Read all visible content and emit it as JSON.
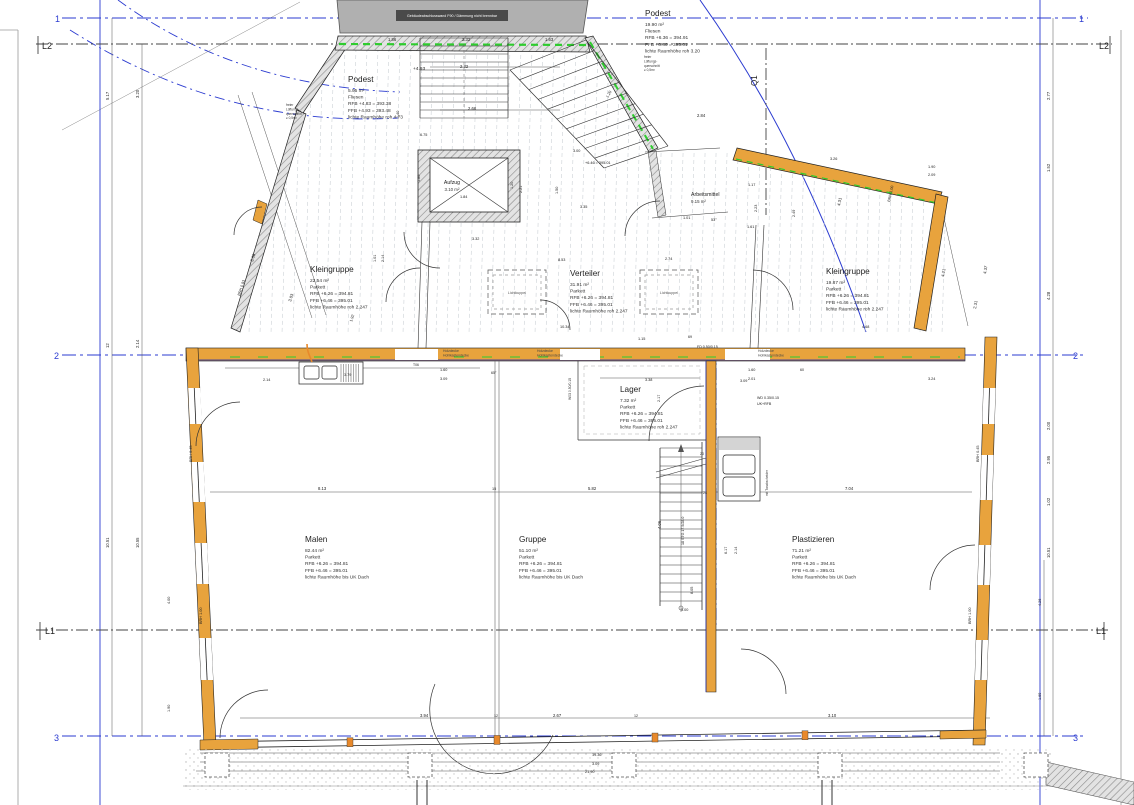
{
  "colors": {
    "axis_blue": "#2b3bd0",
    "wall_orange": "#e8a33d",
    "insulation_green": "#2ecc2e",
    "existing_gray": "#b0b0b0",
    "label_bar_gray": "#4a4a4a",
    "line_black": "#222222"
  },
  "axis_labels": [
    {
      "t": "1",
      "x": 55,
      "y": 22,
      "c": "#2b3bd0",
      "s": 9
    },
    {
      "t": "1",
      "x": 1079,
      "y": 22,
      "c": "#2b3bd0",
      "s": 9
    },
    {
      "t": "L2",
      "x": 42,
      "y": 49,
      "c": "#222222",
      "s": 9
    },
    {
      "t": "L2",
      "x": 1099,
      "y": 49,
      "c": "#222222",
      "s": 9
    },
    {
      "t": "2",
      "x": 54,
      "y": 359,
      "c": "#2b3bd0",
      "s": 9
    },
    {
      "t": "2",
      "x": 1073,
      "y": 359,
      "c": "#2b3bd0",
      "s": 9
    },
    {
      "t": "L1",
      "x": 45,
      "y": 634,
      "c": "#222222",
      "s": 9
    },
    {
      "t": "L1",
      "x": 1096,
      "y": 634,
      "c": "#222222",
      "s": 9
    },
    {
      "t": "3",
      "x": 54,
      "y": 741,
      "c": "#2b3bd0",
      "s": 9
    },
    {
      "t": "3",
      "x": 1073,
      "y": 741,
      "c": "#2b3bd0",
      "s": 9
    },
    {
      "t": "Q1",
      "x": 757,
      "y": 86,
      "c": "#222222",
      "s": 8,
      "r": -90
    }
  ],
  "rooms": [
    {
      "name": "Podest",
      "sub": "+4.93",
      "subx": 413,
      "suby": 70,
      "x": 348,
      "y": 82,
      "area": "5.95 m²",
      "floor": "Fliesen",
      "rfb": "RFB +4.83 = 393.38",
      "ffb": "FFB +4.93 = 393.48",
      "height": "lichte Raumhöhe roh 4.73"
    },
    {
      "name": "Podest",
      "x": 645,
      "y": 16,
      "area": "19.90 m²",
      "floor": "Fliesen",
      "rfb": "RFB +6.36 = 394.91",
      "ffb": "FFB +6.46 = 395.01",
      "height": "lichte Raumhöhe roh 3.20"
    },
    {
      "name": "Kleingruppe",
      "x": 310,
      "y": 272,
      "area": "22.54 m²",
      "floor": "Parkett",
      "rfb": "RFB +6.26 = 394.81",
      "ffb": "FFB +6.46 = 395.01",
      "height": "lichte Raumhöhe roh 2.247"
    },
    {
      "name": "Verteiler",
      "x": 570,
      "y": 276,
      "area": "31.91 m²",
      "floor": "Parkett",
      "rfb": "RFB +6.26 = 394.81",
      "ffb": "FFB +6.46 = 395.01",
      "height": "lichte Raumhöhe roh 2.247"
    },
    {
      "name": "Arbeitsmittel",
      "x": 691,
      "y": 196,
      "area": "9.15 m²",
      "small": true
    },
    {
      "name": "Kleingruppe",
      "x": 826,
      "y": 274,
      "area": "19.87 m²",
      "floor": "Parkett",
      "rfb": "RFB +6.26 = 394.81",
      "ffb": "FFB +6.46 = 395.01",
      "height": "lichte Raumhöhe roh 2.247"
    },
    {
      "name": "Lager",
      "x": 620,
      "y": 392,
      "area": "7.32 m²",
      "floor": "Parkett",
      "rfb": "RFB +6.26 = 394.81",
      "ffb": "FFB +6.46 = 395.01",
      "height": "lichte Raumhöhe roh 2.247"
    },
    {
      "name": "Malen",
      "x": 305,
      "y": 542,
      "area": "82.44 m²",
      "floor": "Parkett",
      "rfb": "RFB +6.26 = 394.81",
      "ffb": "FFB +6.46 = 395.01",
      "height": "lichte Raumhöhe bis UK Dach"
    },
    {
      "name": "Gruppe",
      "x": 519,
      "y": 542,
      "area": "51.10 m²",
      "floor": "Parkett",
      "rfb": "RFB +6.26 = 394.81",
      "ffb": "FFB +6.46 = 395.01",
      "height": "lichte Raumhöhe bis UK Dach"
    },
    {
      "name": "Plastizieren",
      "x": 792,
      "y": 542,
      "area": "71.21 m²",
      "floor": "Parkett",
      "rfb": "RFB +6.26 = 394.81",
      "ffb": "FFB +6.46 = 395.01",
      "height": "lichte Raumhöhe bis UK Dach"
    },
    {
      "name": "Aufzug",
      "x": 452,
      "y": 184,
      "area": "3.10 m²",
      "small": true,
      "anchor": "middle"
    }
  ],
  "notes": [
    {
      "lines": [
        "Gebäudeabschlusswand F90 / Dämmung nicht brennbar"
      ],
      "x": 452,
      "y": 17,
      "s": 3.6,
      "c": "#ffffff",
      "a": "middle"
    },
    {
      "lines": [
        "Lichtkuppel"
      ],
      "x": 517,
      "y": 294,
      "s": 3.6,
      "c": "#555555",
      "a": "middle"
    },
    {
      "lines": [
        "Lichtkuppel"
      ],
      "x": 669,
      "y": 294,
      "s": 3.6,
      "c": "#555555",
      "a": "middle"
    },
    {
      "lines": [
        "Holzdecke",
        "Hohlkastendecke"
      ],
      "x": 443,
      "y": 352,
      "s": 3.4,
      "c": "#444444"
    },
    {
      "lines": [
        "Holzdecke",
        "Hohlkastendecke"
      ],
      "x": 537,
      "y": 352,
      "s": 3.4,
      "c": "#444444"
    },
    {
      "lines": [
        "Holzdecke",
        "Hohlkastendecke"
      ],
      "x": 758,
      "y": 352,
      "s": 3.4,
      "c": "#444444"
    },
    {
      "lines": [
        "freier",
        "Lüftungs-",
        "querschnitt",
        "≥ 0,5m²"
      ],
      "x": 286,
      "y": 106,
      "s": 3.2,
      "c": "#333333"
    },
    {
      "lines": [
        "freier",
        "Lüftungs-",
        "querschnitt",
        "≥ 0,5m²"
      ],
      "x": 644,
      "y": 58,
      "s": 3.2,
      "c": "#333333"
    },
    {
      "lines": [
        "mit Tonabscheider"
      ],
      "x": 768,
      "y": 496,
      "s": 3.2,
      "c": "#333333",
      "r": -90
    }
  ],
  "dim_labels": [
    {
      "t": "5.17",
      "x": 109,
      "y": 100,
      "r": -90
    },
    {
      "t": "3.20",
      "x": 139,
      "y": 98,
      "r": -90
    },
    {
      "t": "12",
      "x": 109,
      "y": 348,
      "r": -90
    },
    {
      "t": "2.14",
      "x": 139,
      "y": 348,
      "r": -90
    },
    {
      "t": "10.51",
      "x": 109,
      "y": 548,
      "r": -90
    },
    {
      "t": "10.55",
      "x": 139,
      "y": 548,
      "r": -90
    },
    {
      "t": "4.00",
      "x": 170,
      "y": 604,
      "r": -90,
      "s": 3.8
    },
    {
      "t": "1.90",
      "x": 170,
      "y": 712,
      "r": -90,
      "s": 3.8
    },
    {
      "t": "BRH 0.45",
      "x": 192,
      "y": 462,
      "r": -90,
      "s": 3.8
    },
    {
      "t": "BRH 1.00",
      "x": 202,
      "y": 624,
      "r": -90,
      "s": 3.8
    },
    {
      "t": "2.77",
      "x": 1050,
      "y": 100,
      "r": -90
    },
    {
      "t": "1.52",
      "x": 1050,
      "y": 172,
      "r": -90
    },
    {
      "t": "4.28",
      "x": 1050,
      "y": 300,
      "r": -90
    },
    {
      "t": "2.00",
      "x": 1050,
      "y": 430,
      "r": -90
    },
    {
      "t": "2.95",
      "x": 1050,
      "y": 464,
      "r": -90
    },
    {
      "t": "1.02",
      "x": 1050,
      "y": 506,
      "r": -90
    },
    {
      "t": "10.51",
      "x": 1050,
      "y": 558,
      "r": -90
    },
    {
      "t": "4.26",
      "x": 1041,
      "y": 606,
      "r": -90,
      "s": 3.8
    },
    {
      "t": "1.69",
      "x": 1041,
      "y": 700,
      "r": -90,
      "s": 3.8
    },
    {
      "t": "BRH 0.45",
      "x": 979,
      "y": 462,
      "r": -90,
      "s": 3.8
    },
    {
      "t": "BRH 1.00",
      "x": 971,
      "y": 624,
      "r": -90,
      "s": 3.8
    },
    {
      "t": "1.86",
      "x": 388,
      "y": 41
    },
    {
      "t": "2.32",
      "x": 462,
      "y": 41
    },
    {
      "t": "1.63",
      "x": 545,
      "y": 41
    },
    {
      "t": "2.32",
      "x": 460,
      "y": 68
    },
    {
      "t": "2.66",
      "x": 468,
      "y": 110
    },
    {
      "t": "1.40",
      "x": 399,
      "y": 118,
      "r": -90,
      "s": 3.8
    },
    {
      "t": "6.75",
      "x": 420,
      "y": 136,
      "s": 3.8
    },
    {
      "t": "3.09",
      "x": 253,
      "y": 262,
      "r": -72
    },
    {
      "t": "3.03",
      "x": 291,
      "y": 302,
      "r": -72
    },
    {
      "t": "1.92",
      "x": 352,
      "y": 322,
      "r": -72,
      "s": 3.8
    },
    {
      "t": "BRH 0.93",
      "x": 240,
      "y": 296,
      "r": -72,
      "s": 3.8
    },
    {
      "t": "1.01",
      "x": 376,
      "y": 262,
      "r": -90,
      "s": 3.8
    },
    {
      "t": "2.14",
      "x": 384,
      "y": 262,
      "r": -90,
      "s": 3.8
    },
    {
      "t": "1.80",
      "x": 420,
      "y": 182,
      "r": -90,
      "s": 3.8
    },
    {
      "t": "2.84",
      "x": 697,
      "y": 117
    },
    {
      "t": "3.00",
      "x": 573,
      "y": 152,
      "s": 3.8
    },
    {
      "t": "+6.46 = 395.01",
      "x": 585,
      "y": 164,
      "s": 3.8
    },
    {
      "t": "3.35",
      "x": 580,
      "y": 208,
      "s": 3.8
    },
    {
      "t": "3.32",
      "x": 472,
      "y": 240,
      "s": 3.8
    },
    {
      "t": "8.53",
      "x": 558,
      "y": 261,
      "s": 3.8
    },
    {
      "t": "2.74",
      "x": 665,
      "y": 260,
      "s": 3.8
    },
    {
      "t": "3.26",
      "x": 830,
      "y": 160,
      "s": 3.8
    },
    {
      "t": "1.90",
      "x": 928,
      "y": 168,
      "s": 3.8
    },
    {
      "t": "2.09",
      "x": 928,
      "y": 176,
      "s": 3.8
    },
    {
      "t": "4.31",
      "x": 840,
      "y": 206,
      "r": -78
    },
    {
      "t": "BRH 1.00",
      "x": 890,
      "y": 202,
      "r": -78,
      "s": 3.8
    },
    {
      "t": "1.20",
      "x": 608,
      "y": 98,
      "r": -60,
      "s": 3.8
    },
    {
      "t": "1.17",
      "x": 748,
      "y": 186,
      "s": 3.8
    },
    {
      "t": "1.61",
      "x": 747,
      "y": 228,
      "s": 3.8
    },
    {
      "t": "1.01",
      "x": 683,
      "y": 219,
      "s": 3.8
    },
    {
      "t": "53°",
      "x": 711,
      "y": 221,
      "s": 3.8
    },
    {
      "t": "2.23",
      "x": 757,
      "y": 212,
      "r": -90,
      "s": 3.8
    },
    {
      "t": "2.49",
      "x": 795,
      "y": 217,
      "r": -90,
      "s": 3.8
    },
    {
      "t": "2.14",
      "x": 263,
      "y": 381,
      "s": 3.8
    },
    {
      "t": "3.79",
      "x": 344,
      "y": 376,
      "s": 3.8
    },
    {
      "t": "T06",
      "x": 413,
      "y": 366,
      "s": 3.4
    },
    {
      "t": "1.60",
      "x": 440,
      "y": 371,
      "s": 3.8
    },
    {
      "t": "3.09",
      "x": 440,
      "y": 380,
      "s": 3.8
    },
    {
      "t": "65°",
      "x": 491,
      "y": 374,
      "s": 3.6
    },
    {
      "t": "1.60",
      "x": 748,
      "y": 371,
      "s": 3.8
    },
    {
      "t": "2.01",
      "x": 748,
      "y": 380,
      "s": 3.8
    },
    {
      "t": "60",
      "x": 800,
      "y": 371,
      "s": 3.6
    },
    {
      "t": "3.24",
      "x": 928,
      "y": 380,
      "s": 3.8
    },
    {
      "t": "3.38",
      "x": 645,
      "y": 381,
      "s": 3.8
    },
    {
      "t": "10.34",
      "x": 560,
      "y": 328,
      "s": 3.8
    },
    {
      "t": "1.15",
      "x": 638,
      "y": 340,
      "s": 3.8
    },
    {
      "t": "69",
      "x": 688,
      "y": 338,
      "s": 3.6
    },
    {
      "t": "FD 0.50/0.15",
      "x": 697,
      "y": 348,
      "s": 3.6
    },
    {
      "t": "W03 0.50/0.15",
      "x": 571,
      "y": 400,
      "r": -90,
      "s": 3.4
    },
    {
      "t": "WD 0.35/0.15",
      "x": 757,
      "y": 399,
      "s": 3.6
    },
    {
      "t": "UK+RFB",
      "x": 757,
      "y": 405,
      "s": 3.6
    },
    {
      "t": "2.17",
      "x": 660,
      "y": 402,
      "r": -90,
      "s": 3.8
    },
    {
      "t": "3.09",
      "x": 740,
      "y": 382,
      "s": 3.8
    },
    {
      "t": "8.13",
      "x": 318,
      "y": 490
    },
    {
      "t": "15",
      "x": 492,
      "y": 490,
      "s": 3.8
    },
    {
      "t": "5.82",
      "x": 588,
      "y": 490
    },
    {
      "t": "7.04",
      "x": 845,
      "y": 490
    },
    {
      "t": "4.06",
      "x": 661,
      "y": 529,
      "r": -90
    },
    {
      "t": "6.17",
      "x": 727,
      "y": 554,
      "r": -90,
      "s": 3.8
    },
    {
      "t": "2.14",
      "x": 737,
      "y": 554,
      "r": -90,
      "s": 3.8
    },
    {
      "t": "1.00",
      "x": 681,
      "y": 611,
      "s": 3.8
    },
    {
      "t": "8.05",
      "x": 693,
      "y": 594,
      "r": -90,
      "s": 3.8
    },
    {
      "t": "20",
      "x": 700,
      "y": 455,
      "s": 3.6
    },
    {
      "t": "24",
      "x": 703,
      "y": 494,
      "s": 3.6
    },
    {
      "t": "18 STG 17.5/28.0",
      "x": 684,
      "y": 545,
      "r": -90,
      "s": 3.6
    },
    {
      "t": "3.94",
      "x": 420,
      "y": 717
    },
    {
      "t": "12",
      "x": 494,
      "y": 717,
      "s": 3.6
    },
    {
      "t": "2.67",
      "x": 553,
      "y": 717
    },
    {
      "t": "12",
      "x": 634,
      "y": 717,
      "s": 3.6
    },
    {
      "t": "3.10",
      "x": 828,
      "y": 717
    },
    {
      "t": "19.36",
      "x": 592,
      "y": 756,
      "s": 3.8
    },
    {
      "t": "3.09",
      "x": 592,
      "y": 765,
      "s": 3.8
    },
    {
      "t": "21.90",
      "x": 585,
      "y": 773,
      "s": 3.8
    },
    {
      "t": "4.68",
      "x": 862,
      "y": 328,
      "s": 3.8
    },
    {
      "t": "4.21",
      "x": 944,
      "y": 277,
      "r": -80
    },
    {
      "t": "2.31",
      "x": 976,
      "y": 309,
      "r": -80
    },
    {
      "t": "4.37",
      "x": 986,
      "y": 274,
      "r": -80
    },
    {
      "t": "1.84",
      "x": 460,
      "y": 198,
      "s": 3.8
    },
    {
      "t": "1.20",
      "x": 513,
      "y": 189,
      "r": -90,
      "s": 3.8
    },
    {
      "t": "2.21",
      "x": 522,
      "y": 193,
      "r": -90,
      "s": 3.8
    },
    {
      "t": "1.50",
      "x": 558,
      "y": 194,
      "r": -90,
      "s": 3.8
    }
  ]
}
